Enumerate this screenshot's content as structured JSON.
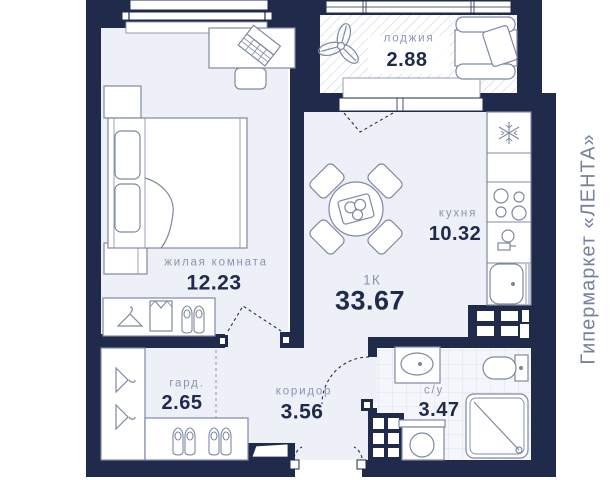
{
  "plan": {
    "side_text": "Гипермаркет «ЛЕНТА»",
    "unit": {
      "type_label": "1К",
      "total_area": "33.67"
    },
    "rooms": {
      "loggia": {
        "name": "лоджия",
        "area": "2.88"
      },
      "living": {
        "name": "жилая комната",
        "area": "12.23"
      },
      "kitchen": {
        "name": "кухня",
        "area": "10.32"
      },
      "wardrobe": {
        "name": "гард.",
        "area": "2.65"
      },
      "corridor": {
        "name": "коридор",
        "area": "3.56"
      },
      "bathroom": {
        "name": "с/у",
        "area": "3.47"
      }
    },
    "colors": {
      "wall": "#202a4b",
      "floor": "#edf0f7",
      "bath_floor": "#f4f6fb",
      "furniture_line": "#7e89a3",
      "room_label": "#8b95ad",
      "area_number": "#202a4b",
      "side_text": "#76819f"
    },
    "icons": {
      "loggia": [
        "plant-icon",
        "sofa"
      ],
      "living": [
        "bed",
        "desk",
        "laptop-icon",
        "chair",
        "nightstand",
        "hanger-icon",
        "shirt-icon",
        "shoes-icon"
      ],
      "kitchen": [
        "dining-table",
        "snowflake-icon",
        "stove-burners-icon",
        "tap-icon",
        "kitchen-sink"
      ],
      "bathroom": [
        "washbasin",
        "toilet",
        "shower",
        "washing-machine"
      ]
    }
  }
}
